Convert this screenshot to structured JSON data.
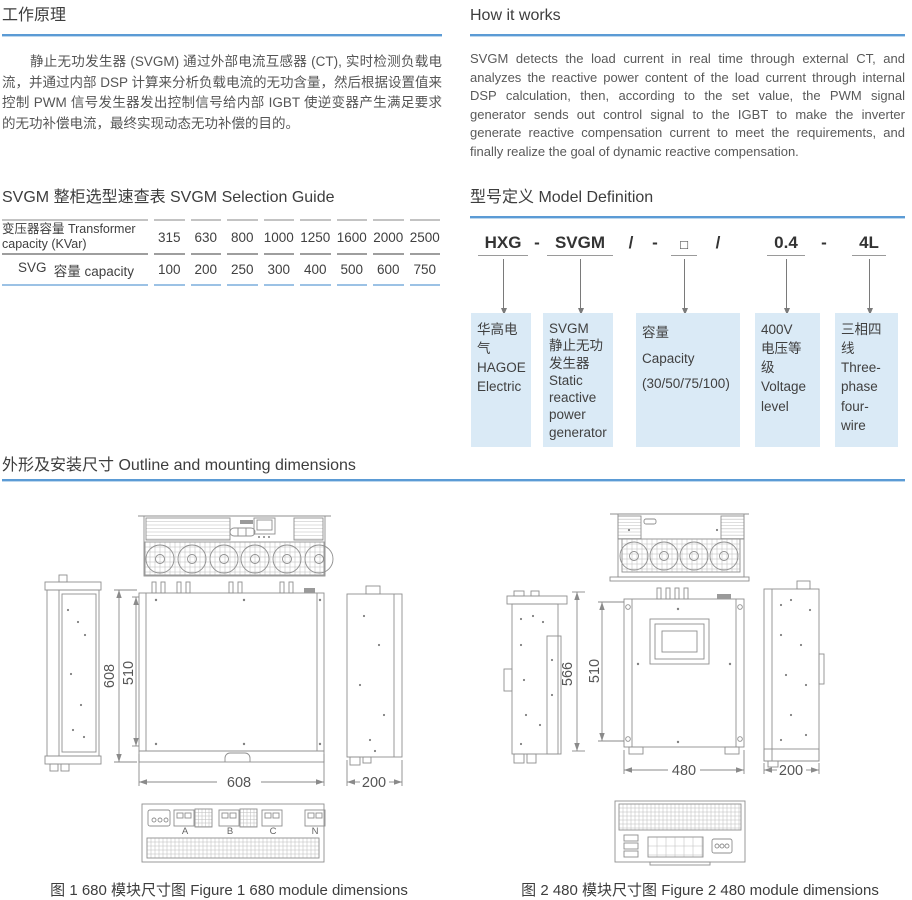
{
  "colors": {
    "accent_blue": "#5b9bd5",
    "box_fill": "#daeaf6",
    "table_bottom_rule": "#9cc2e5",
    "drawing_stroke": "#8f8f8f"
  },
  "working_principle": {
    "title": "工作原理",
    "body": "静止无功发生器 (SVGM) 通过外部电流互感器 (CT), 实时检测负载电流，并通过内部 DSP 计算来分析负载电流的无功含量，然后根据设置值来控制 PWM 信号发生器发出控制信号给内部 IGBT 使逆变器产生满足要求的无功补偿电流，最终实现动态无功补偿的目的。"
  },
  "how_it_works": {
    "title": "How it works",
    "body": "SVGM detects the load current in real time through external CT, and analyzes the reactive power content of the load current through internal DSP calculation, then, according to the set value, the PWM signal generator sends out control signal to the IGBT to make the inverter generate reactive compensation current to meet the requirements, and finally realize the goal of dynamic reactive compensation."
  },
  "selection_guide": {
    "title": "SVGM 整柜选型速查表 SVGM Selection Guide",
    "row1_label": "变压器容量 Transformer capacity (KVar)",
    "row1_values": [
      "315",
      "630",
      "800",
      "1000",
      "1250",
      "1600",
      "2000",
      "2500"
    ],
    "row2_label_a": "SVG",
    "row2_label_b": "容量 capacity",
    "row2_values": [
      "100",
      "200",
      "250",
      "300",
      "400",
      "500",
      "600",
      "750"
    ]
  },
  "model_definition": {
    "title": "型号定义 Model Definition",
    "tokens": {
      "brand": "HXG",
      "sep1": "-",
      "series": "SVGM",
      "sep2": "/",
      "sep3": "-",
      "capacity": "□",
      "sep4": "/",
      "voltage": "0.4",
      "sep5": "-",
      "wires": "4L"
    },
    "boxes": [
      "华高电气\nHAGOE\nElectric",
      "SVGM\n静止无功\n发生器\nStatic\nreactive\npower\ngenerator",
      "容量\nCapacity\n(30/50/75/100)",
      "400V\n电压等级\nVoltage\nlevel",
      "三相四线\nThree-\nphase\nfour-wire"
    ]
  },
  "outline_section": {
    "title": "外形及安装尺寸 Outline and mounting dimensions",
    "figure1": {
      "caption": "图 1  680 模块尺寸图 Figure 1 680 module dimensions",
      "dim_height_outer": "608",
      "dim_height_inner": "510",
      "dim_width": "608",
      "dim_depth": "200",
      "terminals": [
        "A",
        "B",
        "C",
        "N"
      ]
    },
    "figure2": {
      "caption": "图 2 480 模块尺寸图 Figure 2 480 module dimensions",
      "dim_height_outer": "566",
      "dim_height_inner": "510",
      "dim_width": "480",
      "dim_depth": "200"
    }
  }
}
